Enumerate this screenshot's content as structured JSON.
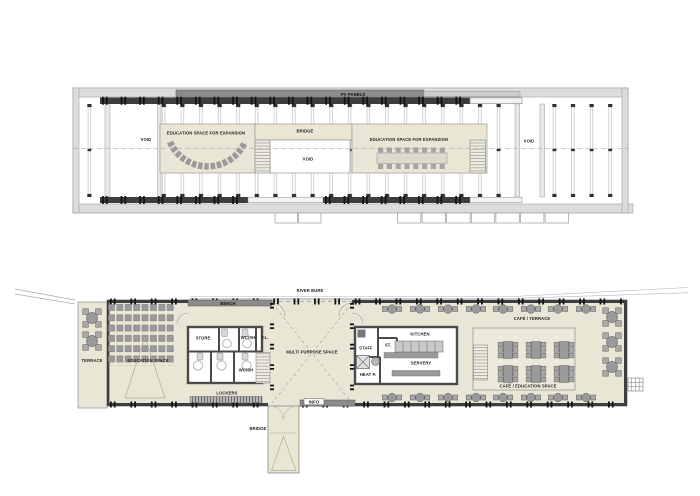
{
  "drawing": {
    "type": "architectural floor plans, upper and ground level",
    "colors": {
      "floor_fill": "#eae6d6",
      "wall_dark": "#3d3d3d",
      "band_gray": "#8c8c8c",
      "frame_light": "#dcdcdc",
      "furniture_gray": "#9a9a9a"
    }
  },
  "upper": {
    "pv_panels": "PV PANELS",
    "void_left": "VOID",
    "education_left": "EDUCATION SPACE FOR EXPANSION",
    "bridge": "BRIDGE",
    "void_center": "VOID",
    "education_right": "EDUCATION SPACE FOR EXPANSION",
    "void_right": "VOID"
  },
  "lower": {
    "river": "RIVER BURE",
    "bench": "BENCH",
    "terrace": "TERRACE",
    "education_space": "EDUCATION SPACE",
    "store": "STORE",
    "wc_sh_top": "WC/SH",
    "cl": "CL.",
    "wc_sh_bottom": "WC/SH",
    "lockers": "LOCKERS",
    "multi_purpose": "MULTI PURPOSE SPACE",
    "info": "INFO",
    "staff": "STAFF",
    "st": "ST.",
    "kitchen": "KITCHEN",
    "servery": "SERVERY",
    "heat_p": "HEAT P.",
    "cafe_terrace": "CAFÉ / TERRACE",
    "cafe_education": "CAFÉ / EDUCATION SPACE",
    "bridge": "BRIDGE"
  }
}
